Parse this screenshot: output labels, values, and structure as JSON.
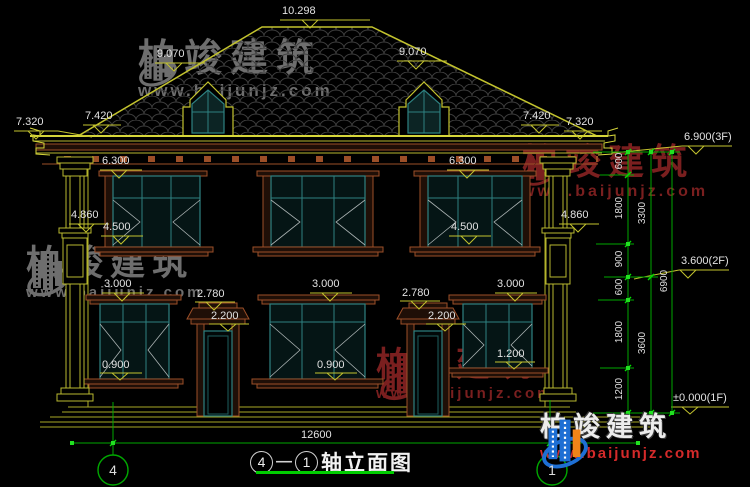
{
  "drawing_title": {
    "axis_start": "4",
    "separator": "—",
    "axis_end": "1",
    "name": "轴立面图"
  },
  "axis_bubbles": {
    "left": "4",
    "right": "1"
  },
  "elevations": {
    "ridge": "10.298",
    "roof_slope_left": "9.070",
    "roof_slope_right": "9.070",
    "eave_outer_left": "7.320",
    "eave_inner_left": "7.420",
    "eave_inner_right": "7.420",
    "eave_outer_right": "7.320",
    "level_3f": "6.900(3F)",
    "level_2f": "3.600(2F)",
    "level_1f": "±0.000(1F)",
    "win2f_head_left": "6.300",
    "win2f_head_right": "6.300",
    "column_band_left": "4.860",
    "column_band_right": "4.860",
    "win2f_sill_left": "4.500",
    "win2f_sill_right": "4.500",
    "win1f_head_left": "3.000",
    "win1f_head_center": "3.000",
    "win1f_head_right": "3.000",
    "door_cap_left": "2.780",
    "door_cap_right": "2.780",
    "door_head_left": "2.200",
    "door_head_right": "2.200",
    "win1f_sill_right": "1.200",
    "win1f_sill_left": "0.900",
    "win1f_sill_center": "0.900"
  },
  "dimensions": {
    "total_width": "12600",
    "right_chain_segments": [
      "600",
      "1800",
      "900",
      "600",
      "1800",
      "1200"
    ],
    "right_chain_subtotals": [
      "3300",
      "3600"
    ],
    "right_chain_overall": "6900"
  },
  "watermark": {
    "brand": "柏竣建筑",
    "url": "www.baijunjz.com"
  },
  "footer_logo": {
    "brand": "柏竣建筑",
    "url": "www.baijunjz.com"
  },
  "colors": {
    "line_olive": "#c3c32e",
    "dimension_green": "#00a800",
    "window_teal": "#2e8181",
    "trim_brown": "#9c4f28",
    "title_underline_green": "#00cc00",
    "watermark_gray": "#6e6e6e",
    "watermark_red": "#7a1f1f",
    "logo_blue": "#1e6fd4",
    "logo_orange": "#ef8418",
    "url_red": "#d42a2a"
  }
}
